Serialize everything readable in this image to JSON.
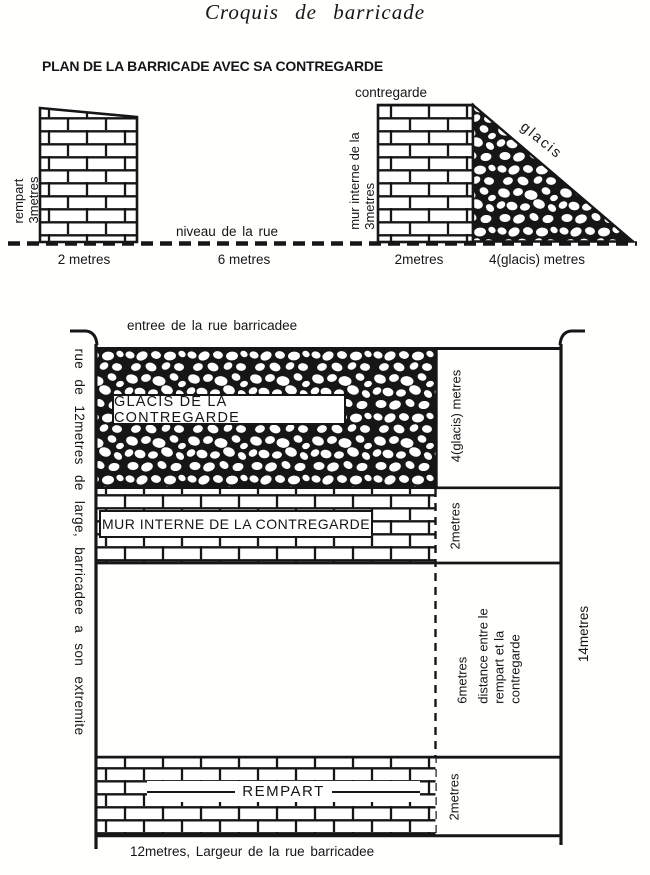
{
  "title": "Croquis de barricade",
  "subtitle": "PLAN DE LA BARRICADE AVEC SA CONTREGARDE",
  "colors": {
    "ink": "#161616",
    "paper": "#fffffe"
  },
  "cross_section": {
    "rempart_line1": "rempart",
    "rempart_line2": "3metres",
    "contregarde_label": "contregarde",
    "mur_line1": "mur interne de la",
    "mur_line2": "3metres",
    "glacis_label": "glacis",
    "street_level": "niveau de la rue",
    "dim_rempart": "2 metres",
    "dim_street": "6 metres",
    "dim_mur": "2metres",
    "dim_glacis": "4(glacis) metres"
  },
  "plan": {
    "entry_label": "entree de la rue barricadee",
    "street_side_label": "rue de 12metres de large, barricadee a son extremite",
    "glacis_box": "GLACIS DE LA CONTREGARDE",
    "mur_box": "MUR INTERNE DE LA CONTREGARDE",
    "rempart_box": "REMPART",
    "dim_glacis": "4(glacis) metres",
    "dim_mur": "2metres",
    "dim_gap": "6metres",
    "gap_desc_1": "distance entre le",
    "gap_desc_2": "rempart et la",
    "gap_desc_3": "contregarde",
    "dim_total": "14metres",
    "bottom_caption": "12metres, Largeur de la rue barricadee"
  }
}
